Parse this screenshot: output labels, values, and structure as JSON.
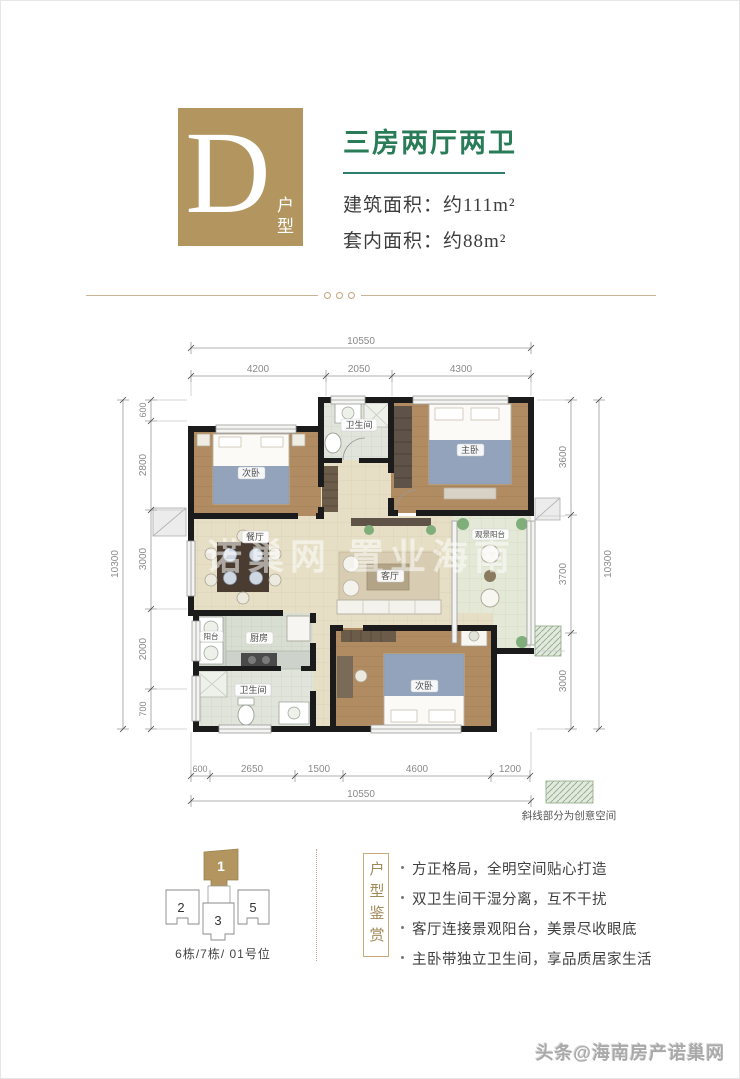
{
  "header": {
    "type_letter": "D",
    "type_label": "户型",
    "title": "三房两厅两卫",
    "area_lines": [
      {
        "label": "建筑面积：",
        "value": "约111m²"
      },
      {
        "label": "套内面积：",
        "value": "约88m²"
      }
    ],
    "accent_gold": "#b3965f",
    "accent_green": "#2a7c58",
    "underline_color": "#2f7d6b"
  },
  "floorplan": {
    "dims_top": {
      "overall": "10550",
      "segments": [
        "4200",
        "2050",
        "4300"
      ]
    },
    "dims_bottom": {
      "overall": "10550",
      "segments": [
        "600",
        "2650",
        "1500",
        "4600",
        "1200"
      ]
    },
    "dims_left": {
      "overall": "10300",
      "segments": [
        "600",
        "2800",
        "3000",
        "2000",
        "700"
      ]
    },
    "dims_right": {
      "overall": "10300",
      "segments": [
        "3600",
        "3700",
        "3000"
      ]
    },
    "rooms": [
      {
        "id": "bedroom-2",
        "label": "次卧"
      },
      {
        "id": "bath-top",
        "label": "卫生间"
      },
      {
        "id": "master-bedroom",
        "label": "主卧"
      },
      {
        "id": "dining",
        "label": "餐厅"
      },
      {
        "id": "living",
        "label": "客厅"
      },
      {
        "id": "view-balcony",
        "label": "观景阳台"
      },
      {
        "id": "service-balcony",
        "label": "阳台"
      },
      {
        "id": "kitchen",
        "label": "厨房"
      },
      {
        "id": "bath-bottom",
        "label": "卫生间"
      },
      {
        "id": "bedroom-3",
        "label": "次卧"
      }
    ],
    "legend_note": "斜线部分为创意空间",
    "watermark": "诺巢网  置业海南",
    "wall_color": "#1b1b1b"
  },
  "location": {
    "units": [
      {
        "num": "1",
        "highlighted": true
      },
      {
        "num": "2",
        "highlighted": false
      },
      {
        "num": "3",
        "highlighted": false
      },
      {
        "num": "5",
        "highlighted": false
      }
    ],
    "caption": "6栋/7栋/ 01号位"
  },
  "appreciation": {
    "side_label": "户型鉴赏",
    "bullets": [
      "方正格局，全明空间贴心打造",
      "双卫生间干湿分离，互不干扰",
      "客厅连接景观阳台，美景尽收眼底",
      "主卧带独立卫生间，享品质居家生活"
    ]
  },
  "footer": {
    "watermark": "头条@海南房产诺巢网"
  }
}
